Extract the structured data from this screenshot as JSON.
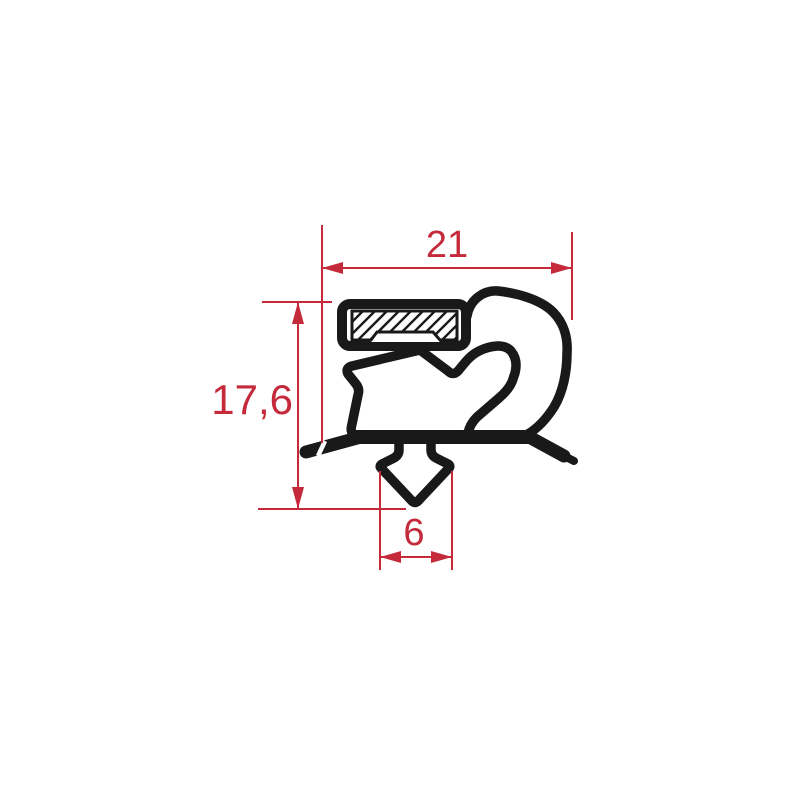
{
  "drawing": {
    "labels": {
      "width": "21",
      "height": "17,6",
      "dart": "6"
    },
    "colors": {
      "dimension_red": "#c42a3a",
      "profile_black": "#191919",
      "background": "#ffffff"
    }
  }
}
